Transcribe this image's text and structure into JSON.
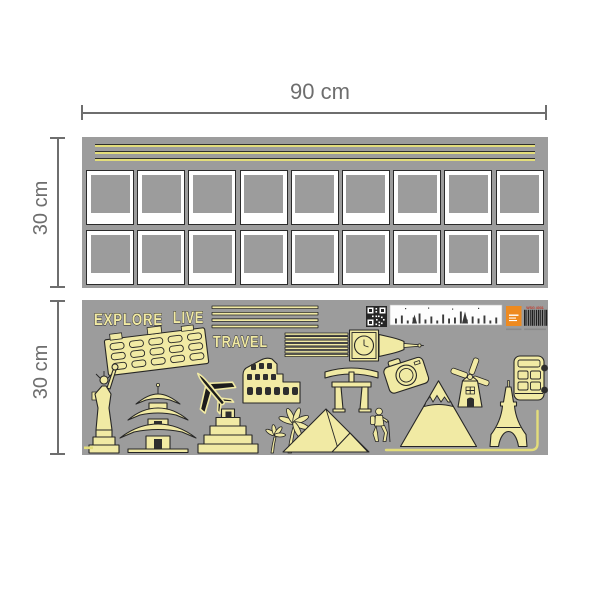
{
  "page": {
    "background_color": "#ffffff"
  },
  "dimension_labels": {
    "top_width": "90 cm",
    "top_sheet_height": "30 cm",
    "bottom_sheet_height": "30 cm"
  },
  "colors": {
    "sheet_gray": "#9c9c9c",
    "sticker_cream": "#f1eaa4",
    "stripe_yellow": "#e3dd7a",
    "outline_dark": "#262626",
    "dimension_gray": "#6e6e6e",
    "logo_orange": "#ee8a1f",
    "code_red": "#c0392b",
    "frame_white": "#ffffff"
  },
  "top_sheet": {
    "stripe_count": 3,
    "frame_rows": 2,
    "frame_columns": 9,
    "frames_total": 18
  },
  "bottom_sheet": {
    "words": {
      "explore": "EXPLORE",
      "live": "LIVE",
      "travel": "TRAVEL"
    },
    "product_code": "WSG 4031",
    "stickers": [
      "stripe-lines",
      "statue-of-liberty",
      "building",
      "airplane",
      "pagoda",
      "colosseum",
      "mayan-pyramid",
      "palm-trees",
      "giza-pyramids",
      "torii-gate",
      "big-ben",
      "camera",
      "hiker",
      "mountain",
      "windmill",
      "eiffel-tower",
      "bus",
      "qr-code",
      "city-skyline-label",
      "brand-logo",
      "barcode",
      "border-line"
    ]
  }
}
